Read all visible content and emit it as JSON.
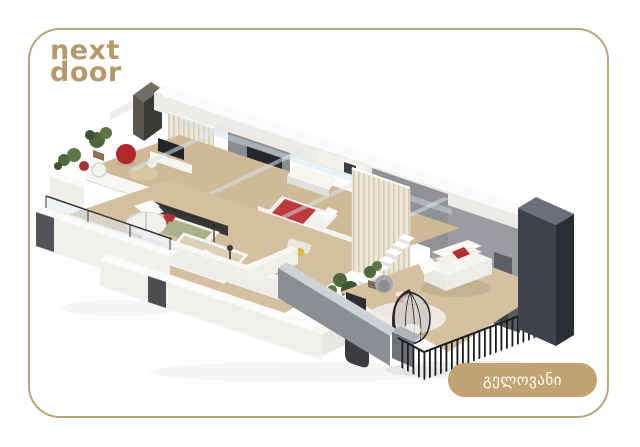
{
  "page": {
    "background_color": "#ffffff"
  },
  "card": {
    "background_color": "#ffffff",
    "border_color": "#b3a77c"
  },
  "logo": {
    "line1": "next",
    "line2": "door",
    "color": "#b49a6b"
  },
  "badge": {
    "label": "გელოვანი",
    "background_color": "#c2a373",
    "text_color": "#fffdf8"
  },
  "scene": {
    "type": "isometric-apartment-cutaway-render",
    "alt": "3D isometric cutaway render of a two-level duplex apartment with living room, bedrooms, bathroom, two staircases, slatted screens and a furnished terrace",
    "palette": {
      "wall_white": "#f6f5f2",
      "wall_gray": "#97999d",
      "slab_dark": "#3f434b",
      "floor_wood": "#cfb996",
      "accent_red": "#b42f33",
      "bed_green": "#a9b08a",
      "plant_green": "#4f683e",
      "glass_blue": "#cfe2ec",
      "railing_black": "#1b1c1e"
    },
    "elements": [
      "chimney-block",
      "roof-frame",
      "glass-beams",
      "interior-gray-walls",
      "slat-wall",
      "mezzanine-floor",
      "living-room-furniture",
      "kitchen",
      "red-bed",
      "green-bed",
      "bathroom",
      "spiral-staircase",
      "main-staircase",
      "slat-screen",
      "lower-walls",
      "glass-balustrade",
      "terrace",
      "sofa",
      "hanging-egg-chair",
      "railing",
      "parapet",
      "dark-slab"
    ]
  }
}
